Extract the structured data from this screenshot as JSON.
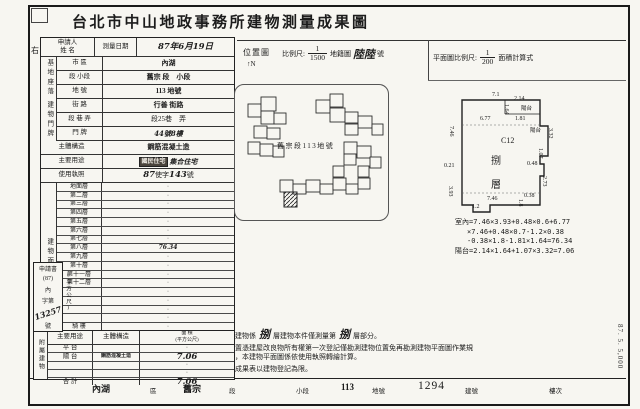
{
  "title": "台北市中山地政事務所建物測量成果圖",
  "margin": {
    "left_mark": "右",
    "print_code": "87. 5. 5,000"
  },
  "survey_row": {
    "applicant_line1": "申請人",
    "applicant_line2": "姓 名",
    "date_label": "測量日期",
    "date_value": "87年6月19日"
  },
  "site_group": {
    "label": "基地座落",
    "rows": [
      {
        "label": "市 區",
        "value": "內湖"
      },
      {
        "label": "段 小段",
        "value": "舊宗 段　小段"
      },
      {
        "label": "地 號",
        "value": "113 地號"
      }
    ]
  },
  "door_group": {
    "label": "建物門牌",
    "rows": [
      {
        "label": "街 路",
        "value": "行善 街路"
      },
      {
        "label": "段 巷 弄",
        "value": "段25巷　弄"
      },
      {
        "label": "門 牌",
        "value": "44號8樓"
      }
    ]
  },
  "simple_rows": {
    "structure": {
      "label": "主體構造",
      "value": "鋼筋混凝土造"
    },
    "usage": {
      "label": "主要用途",
      "stamp": "國民住宅",
      "value": "集合住宅"
    },
    "license": {
      "label": "使用執照",
      "pre": "87",
      "mid": "使字",
      "num": "143",
      "suf": "號"
    }
  },
  "area_table": {
    "group_label": "建物面積",
    "unit": "(平方公尺)",
    "rows": [
      {
        "label": "地面層",
        "value": "·"
      },
      {
        "label": "第二層",
        "value": "·"
      },
      {
        "label": "第三層",
        "value": "·"
      },
      {
        "label": "第四層",
        "value": "·"
      },
      {
        "label": "第五層",
        "value": "·"
      },
      {
        "label": "第六層",
        "value": "·"
      },
      {
        "label": "第七層",
        "value": "·"
      },
      {
        "label": "第八層",
        "value": "76.34",
        "hand": true
      },
      {
        "label": "第九層",
        "value": "·"
      },
      {
        "label": "第十層",
        "value": "·"
      },
      {
        "label": "第十一層",
        "value": "·"
      },
      {
        "label": "第十二層",
        "value": "·"
      },
      {
        "label": "",
        "value": "·"
      },
      {
        "label": "",
        "value": "·"
      },
      {
        "label": "",
        "value": "·"
      },
      {
        "label": "",
        "value": "·"
      },
      {
        "label": "騎 樓",
        "value": "·"
      }
    ],
    "total_label": "合 計",
    "total_value": "76.34"
  },
  "application_box": {
    "lines": [
      "申請書",
      "(87)",
      "內",
      "字第"
    ],
    "number": "13257",
    "suffix": "號"
  },
  "annex_table": {
    "group_label": "附屬建物",
    "col_use": "主要用途",
    "col_structure": "主體構造",
    "col_area1": "面 積",
    "col_area2": "(平方公尺)",
    "rows": [
      {
        "use": "平 台",
        "structure": "",
        "value": "·"
      },
      {
        "use": "陽 台",
        "structure": "鋼筋混凝土造",
        "value": "7.06",
        "hand": true
      },
      {
        "use": "",
        "structure": "",
        "value": "·"
      },
      {
        "use": "",
        "structure": "",
        "value": "·"
      },
      {
        "use": "合 計",
        "structure": "",
        "value": "7.06",
        "hand": true
      }
    ]
  },
  "location_map": {
    "label": "位置圖",
    "north_arrow": "↑",
    "north": "N",
    "scale_prefix": "比例尺:",
    "num": "1",
    "den": "1500",
    "map_name": "地籍圖",
    "sheet": "陸陸",
    "sheet_unit": "號",
    "parcel_label": "舊宗段113地號"
  },
  "plan_header": {
    "prefix": "平面圖比例尺:",
    "num": "1",
    "den": "200",
    "suffix": "面積計算式"
  },
  "floor_plan": {
    "dims": [
      {
        "t": "7.1",
        "x": 492,
        "y": 92
      },
      {
        "t": "2.14",
        "x": 514,
        "y": 96
      },
      {
        "t": "陽台",
        "x": 521,
        "y": 104,
        "s": 5.5
      },
      {
        "t": "1.64",
        "x": 503,
        "y": 104,
        "v": true
      },
      {
        "t": "6.77",
        "x": 480,
        "y": 116
      },
      {
        "t": "1.81",
        "x": 515,
        "y": 116
      },
      {
        "t": "陽台",
        "x": 530,
        "y": 126,
        "s": 5.5
      },
      {
        "t": "3.32",
        "x": 547,
        "y": 128,
        "v": true
      },
      {
        "t": "1.07",
        "x": 537,
        "y": 148,
        "v": true
      },
      {
        "t": "0.48",
        "x": 527,
        "y": 161
      },
      {
        "t": "C12",
        "x": 501,
        "y": 136,
        "s": 8
      },
      {
        "t": "捌",
        "x": 491,
        "y": 152,
        "s": 10
      },
      {
        "t": "層",
        "x": 491,
        "y": 176,
        "s": 10
      },
      {
        "t": "7.46",
        "x": 448,
        "y": 126,
        "v": true
      },
      {
        "t": "0.21",
        "x": 444,
        "y": 163
      },
      {
        "t": "3.93",
        "x": 447,
        "y": 186,
        "v": true
      },
      {
        "t": "7.46",
        "x": 487,
        "y": 196
      },
      {
        "t": "1.2",
        "x": 472,
        "y": 204
      },
      {
        "t": "0.38",
        "x": 524,
        "y": 193
      },
      {
        "t": "1.8",
        "x": 517,
        "y": 199,
        "v": true
      },
      {
        "t": "2.73",
        "x": 541,
        "y": 176,
        "v": true
      }
    ]
  },
  "calc_lines": [
    "室內=7.46×3.93+0.48×0.6+6.77",
    "×7.46+0.48×0.7-1.2×0.38",
    "-0.38×1.8-1.81×1.64=76.34",
    "陽台=2.14×1.64+1.07×3.32=7.06"
  ],
  "notes": [
    {
      "no": "一、",
      "parts": [
        {
          "t": "本建物係"
        },
        {
          "t": "捌",
          "hand": true
        },
        {
          "t": "層建物本件僅測量第"
        },
        {
          "t": "捌",
          "hand": true
        },
        {
          "t": "層部分。"
        }
      ]
    },
    {
      "no": "二、",
      "parts": [
        {
          "t": "依置憑建屋改良物所有權第一次登記僅勘測建物位置免再勘測建物平面圖作業規定，本建物平面圖係依使用執照轉繪計算。"
        }
      ]
    },
    {
      "no": "三、",
      "parts": [
        {
          "t": "本成果表以建物登記為限。"
        }
      ]
    }
  ],
  "footer": {
    "items": [
      {
        "value": "內湖",
        "vx": 92,
        "label": "區",
        "lx": 150,
        "stamp": true
      },
      {
        "value": "舊宗",
        "vx": 183,
        "label": "段",
        "lx": 229,
        "stamp": true
      },
      {
        "value": "",
        "vx": 0,
        "label": "小段",
        "lx": 296
      },
      {
        "value": "113",
        "vx": 341,
        "label": "地號",
        "lx": 372,
        "stamp": true
      },
      {
        "value": "1294",
        "vx": 418,
        "label": "建號",
        "lx": 465,
        "big": true
      },
      {
        "value": "",
        "vx": 0,
        "label": "樓次",
        "lx": 549
      }
    ]
  }
}
